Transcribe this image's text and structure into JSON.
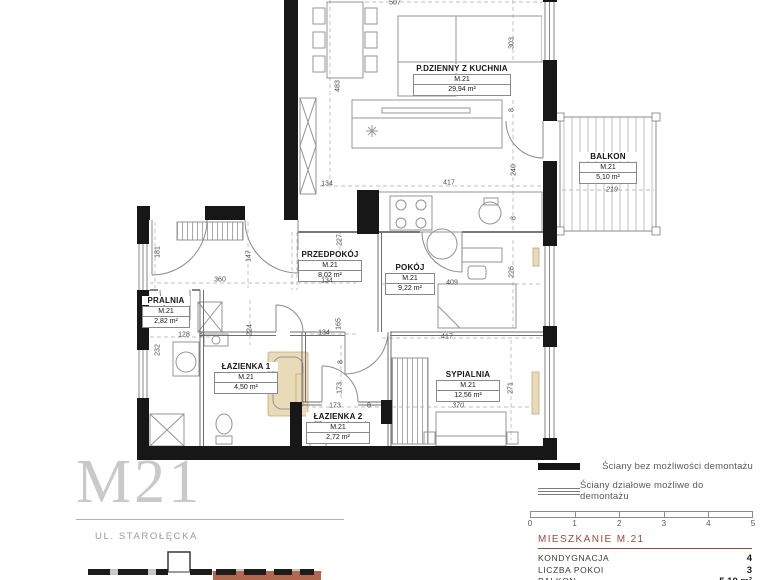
{
  "colors": {
    "accent": "#9e4a36",
    "highlight": "#b2684e",
    "wall": "#171717",
    "beige": "#eadbb8"
  },
  "plan": {
    "rooms": [
      {
        "name": "P.DZIENNY Z KUCHNIA",
        "unit": "M.21",
        "area": "29,94 m²",
        "x": 462,
        "y": 64,
        "bw": 96
      },
      {
        "name": "BALKON",
        "unit": "M.21",
        "area": "5,10 m²",
        "x": 608,
        "y": 152,
        "bw": 56
      },
      {
        "name": "PRZEDPOKÓJ",
        "unit": "M.21",
        "area": "8,02 m²",
        "x": 330,
        "y": 250,
        "bw": 62
      },
      {
        "name": "POKÓJ",
        "unit": "M.21",
        "area": "9,22 m²",
        "x": 410,
        "y": 263,
        "bw": 48
      },
      {
        "name": "PRALNIA",
        "unit": "M.21",
        "area": "2,82 m²",
        "x": 166,
        "y": 296,
        "bw": 46
      },
      {
        "name": "ŁAZIENKA 1",
        "unit": "M.21",
        "area": "4,50 m²",
        "x": 246,
        "y": 362,
        "bw": 62
      },
      {
        "name": "ŁAZIENKA 2",
        "unit": "M.21",
        "area": "2,72 m²",
        "x": 338,
        "y": 412,
        "bw": 62
      },
      {
        "name": "SYPIALNIA",
        "unit": "M.21",
        "area": "12,56 m²",
        "x": 468,
        "y": 370,
        "bw": 62
      }
    ],
    "dimensions": [
      {
        "t": "507",
        "x": 395,
        "y": 3
      },
      {
        "t": "303",
        "x": 512,
        "y": 43,
        "r": 1
      },
      {
        "t": "8",
        "x": 512,
        "y": 110,
        "r": 1
      },
      {
        "t": "483",
        "x": 338,
        "y": 86,
        "r": 1
      },
      {
        "t": "134",
        "x": 327,
        "y": 184
      },
      {
        "t": "417",
        "x": 449,
        "y": 183
      },
      {
        "t": "240",
        "x": 514,
        "y": 170,
        "r": 1
      },
      {
        "t": "8",
        "x": 514,
        "y": 218,
        "r": 1
      },
      {
        "t": "219",
        "x": 612,
        "y": 190,
        "i": 1
      },
      {
        "t": "227",
        "x": 340,
        "y": 240,
        "r": 1
      },
      {
        "t": "181",
        "x": 158,
        "y": 252,
        "r": 1
      },
      {
        "t": "147",
        "x": 249,
        "y": 256,
        "r": 1
      },
      {
        "t": "360",
        "x": 220,
        "y": 280
      },
      {
        "t": "134",
        "x": 327,
        "y": 281
      },
      {
        "t": "409",
        "x": 452,
        "y": 283
      },
      {
        "t": "226",
        "x": 512,
        "y": 272,
        "r": 1
      },
      {
        "t": "128",
        "x": 184,
        "y": 335
      },
      {
        "t": "8",
        "x": 201,
        "y": 335
      },
      {
        "t": "232",
        "x": 158,
        "y": 350,
        "r": 1
      },
      {
        "t": "224",
        "x": 250,
        "y": 330,
        "r": 1
      },
      {
        "t": "165",
        "x": 339,
        "y": 324,
        "r": 1
      },
      {
        "t": "134",
        "x": 324,
        "y": 333
      },
      {
        "t": "417",
        "x": 447,
        "y": 337
      },
      {
        "t": "8",
        "x": 341,
        "y": 362,
        "r": 1
      },
      {
        "t": "173",
        "x": 340,
        "y": 388,
        "r": 1
      },
      {
        "t": "173",
        "x": 335,
        "y": 406
      },
      {
        "t": "8",
        "x": 369,
        "y": 406
      },
      {
        "t": "271",
        "x": 511,
        "y": 388,
        "r": 1
      },
      {
        "t": "370",
        "x": 458,
        "y": 406,
        "i": 1
      }
    ]
  },
  "legend": {
    "items": [
      {
        "style": "solid",
        "label": "Ściany bez możliwości demontażu"
      },
      {
        "style": "double",
        "label": "Ściany działowe możliwe do demontażu"
      }
    ],
    "scale_ticks": [
      "0",
      "1",
      "2",
      "3",
      "4",
      "5"
    ]
  },
  "info": {
    "heading": "MIESZKANIE M.21",
    "rows": [
      {
        "label": "KONDYGNACJA",
        "value": "4"
      },
      {
        "label": "LICZBA POKOI",
        "value": "3"
      },
      {
        "label": "BALKON",
        "value": "5,10 m²"
      }
    ]
  },
  "branding": {
    "title": "M21",
    "street": "UL. STAROŁĘCKA"
  }
}
